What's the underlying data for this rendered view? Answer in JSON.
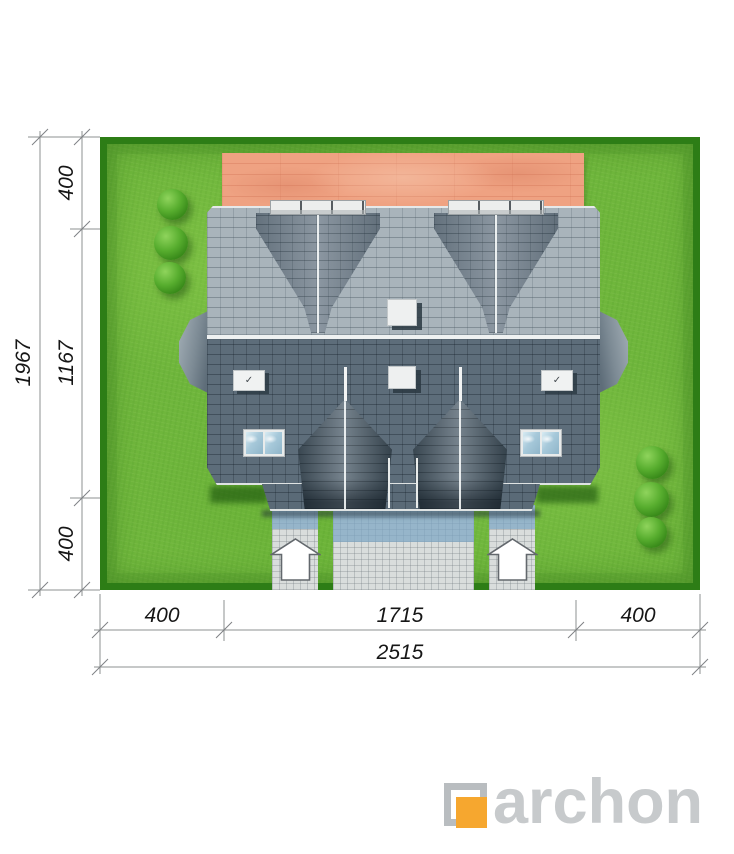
{
  "plan": {
    "title": "house top view site plan",
    "dimensions_cm": {
      "plot_depth_total": "1967",
      "plot_width_total": "2515",
      "left_segments": [
        "400",
        "1167",
        "400"
      ],
      "bottom_segments": [
        "400",
        "1715",
        "400"
      ]
    }
  },
  "branding": {
    "logo_text": "archon",
    "logo_orange": "#F6A72F",
    "logo_gray": "#C7CACC"
  },
  "icons": {
    "entrance_arrow": "up-arrow",
    "hatch_handle": "✓"
  },
  "palette": {
    "lawn_green": "#6FB63C",
    "hedge_green": "#2D7D16",
    "roof_light": "#A9B4BB",
    "roof_dark": "#5D6D7A",
    "dormer_gray": "#7B8894",
    "terrace_wood": "#EFA282",
    "pavement_gray": "#D9DDDC",
    "pavement_blue": "#9FC0D4",
    "skylight_glass": "#A7C9DA",
    "dimension_line": "#8D9092"
  }
}
